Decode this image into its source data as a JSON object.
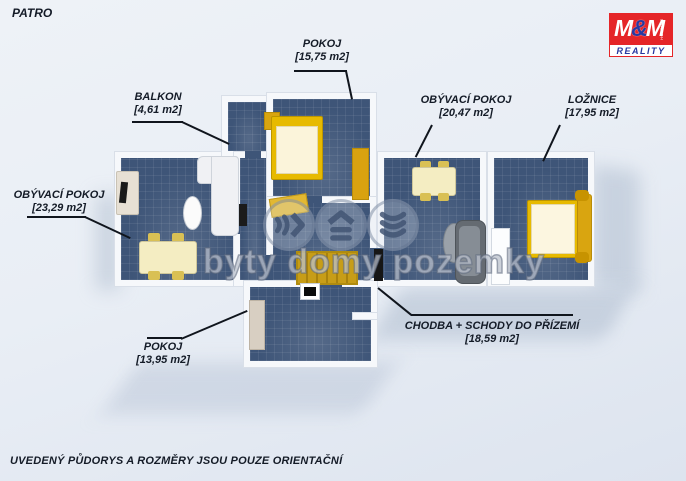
{
  "header": {
    "floor_label": "PATRO"
  },
  "logo": {
    "m1": "M",
    "amp": "&",
    "m2": "M",
    "holding": "HOLDING",
    "reality": "REALITY"
  },
  "watermark": {
    "text": "byty domy pozemky",
    "icons": [
      "fast-forward-arrows-icon",
      "house-roof-icon",
      "chevron-stack-down-icon"
    ]
  },
  "rooms": {
    "pokoj_top": {
      "name": "POKOJ",
      "area": "[15,75 m2]"
    },
    "balkon": {
      "name": "BALKON",
      "area": "[4,61 m2]"
    },
    "obyvaci_right": {
      "name": "OBÝVACÍ POKOJ",
      "area": "[20,47 m2]"
    },
    "loznice": {
      "name": "LOŽNICE",
      "area": "[17,95 m2]"
    },
    "obyvaci_left": {
      "name": "OBÝVACÍ POKOJ",
      "area": "[23,29 m2]"
    },
    "pokoj_bottom": {
      "name": "POKOJ",
      "area": "[13,95 m2]"
    },
    "chodba": {
      "name": "CHODBA + SCHODY DO PŘÍZEMÍ",
      "area": "[18,59 m2]"
    }
  },
  "footer": {
    "disclaimer": "UVEDENÝ PŮDORYS A ROZMĚRY JSOU POUZE ORIENTAČNÍ"
  },
  "colors": {
    "floor": "#3e5578",
    "wall": "#f6f8fb",
    "accent_yellow": "#e3b400",
    "logo_red": "#e52528",
    "logo_blue": "#2838a0",
    "label_text": "#141b27"
  }
}
